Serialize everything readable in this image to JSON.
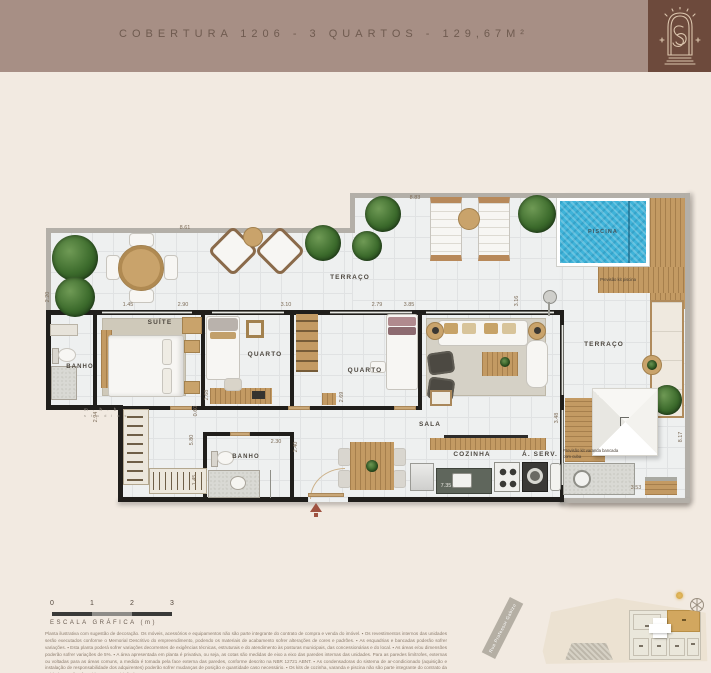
{
  "header": {
    "title": "COBERTURA 1206 - 3 QUARTOS - 129,67M²"
  },
  "plan": {
    "labels": {
      "terraco_top": "TERRAÇO",
      "terraco_right": "TERRAÇO",
      "piscina": "PISCINA",
      "suite": "SUÍTE",
      "banho_suite": "BANHO",
      "quarto1": "QUARTO",
      "quarto2": "QUARTO",
      "sala": "SALA",
      "cozinha": "COZINHA",
      "area_servico": "Á. SERV.",
      "banho2": "BANHO"
    },
    "notes": {
      "kit_piscina": "Previsão kit piscina",
      "kit_varanda_1": "Previsão kit varanda bancada",
      "kit_varanda_2": "com cuba",
      "watermark_1": "m . h . b",
      "watermark_2": "s t u d i o s"
    },
    "dims": [
      "8.61",
      "8.83",
      "2.20",
      "1.45",
      "2.90",
      "3.10",
      "2.79",
      "3.85",
      "3.16",
      "2.68",
      "2.69",
      "2.94",
      "0.60",
      "5.80",
      "2.30",
      "2.40",
      "1.45",
      "3.48",
      "7.35",
      "3.53",
      "8.17"
    ]
  },
  "scale": {
    "ticks": [
      "0",
      "1",
      "2",
      "3"
    ],
    "label": "ESCALA GRÁFICA (m)"
  },
  "disclaimer": "Planta ilustrativa com sugestão de decoração. Os móveis, acessórios e equipamentos não são parte integrante do contrato de compra e venda do imóvel. ▪ Os revestimentos internos das unidades serão executados conforme o Memorial Descritivo do empreendimento, podendo os materiais de acabamento sofrer alterações de cores e padrões. ▪ As esquadrias e bancadas poderão sofrer variações. ▪ Esta planta poderá sofrer variações decorrentes de exigências técnicas, estruturais e do atendimento às posturas municipais, das concessionárias e do local. ▪ As áreas e/ou dimensões poderão sofrer variações de 5%. ▪ A área apresentada em planta é privativa, ou seja, as cotas são medidas de eixo a eixo das paredes internas das unidades. Para as paredes limítrofes, externas ou voltadas para as áreas comuns, a medida é tomada pela face externa das paredes, conforme descrito na NBR 12721 ABNT. ▪ As condensadoras do sistema de ar-condicionado (aquisição e instalação de responsabilidade dos adquirentes) poderão sofrer mudanças de posição e quantidade caso necessário. ▪ Os kits de cozinha, varanda e piscina não são parte integrante do contrato da unidade e serão oferecidos para aquisição à parte.",
  "keymap": {
    "street": "Rua Professor Gabizo"
  }
}
